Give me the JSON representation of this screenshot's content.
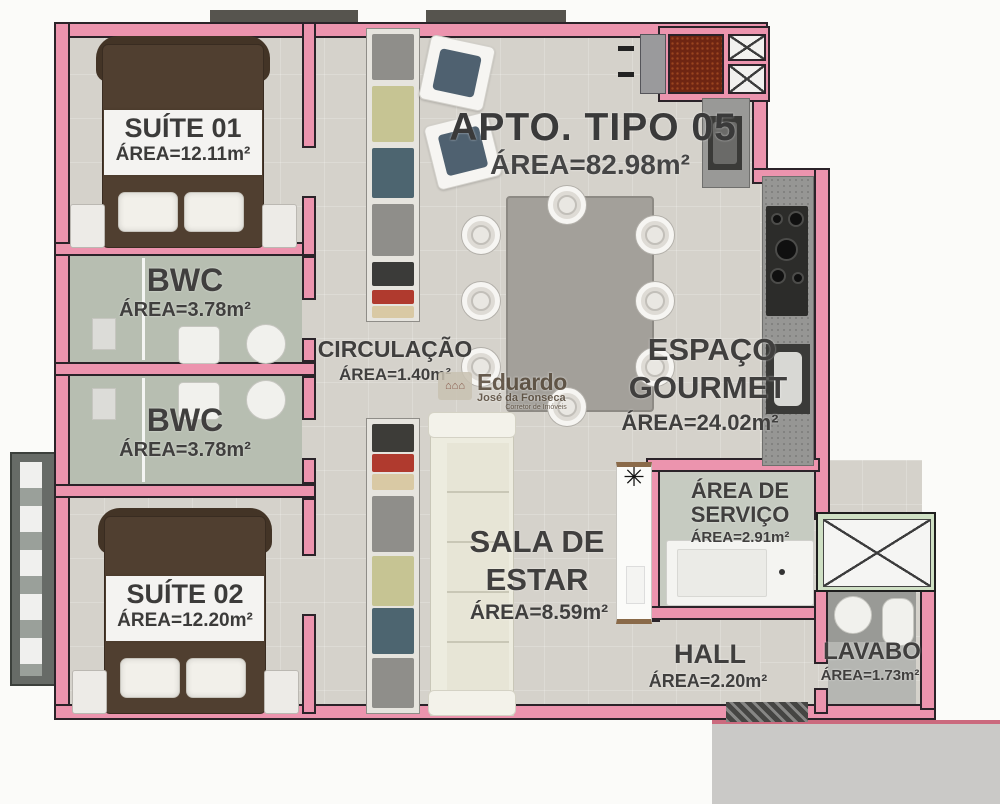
{
  "title": {
    "name": "APTO. TIPO 05",
    "area": "ÁREA=82.98m²"
  },
  "rooms": {
    "suite01": {
      "name": "SUÍTE 01",
      "area": "ÁREA=12.11m²"
    },
    "bwc1": {
      "name": "BWC",
      "area": "ÁREA=3.78m²"
    },
    "bwc2": {
      "name": "BWC",
      "area": "ÁREA=3.78m²"
    },
    "suite02": {
      "name": "SUÍTE 02",
      "area": "ÁREA=12.20m²"
    },
    "circulacao": {
      "name": "CIRCULAÇÃO",
      "area": "ÁREA=1.40m²"
    },
    "gourmet": {
      "line1": "ESPAÇO",
      "line2": "GOURMET",
      "area": "ÁREA=24.02m²"
    },
    "sala": {
      "line1": "SALA DE",
      "line2": "ESTAR",
      "area": "ÁREA=8.59m²"
    },
    "servico": {
      "line1": "ÁREA DE",
      "line2": "SERVIÇO",
      "area": "ÁREA=2.91m²"
    },
    "hall": {
      "name": "HALL",
      "area": "ÁREA=2.20m²"
    },
    "lavabo": {
      "name": "LAVABO",
      "area": "ÁREA=1.73m²"
    }
  },
  "watermark": {
    "name": "Eduardo",
    "subtitle": "José da Fonseca",
    "tagline": "Corretor de Imóveis"
  },
  "colors": {
    "wall_pink": "#ec94ae",
    "floor_gray": "#d5d2cb",
    "bwc_green": "#b7beb1",
    "bed_brown": "#503f30",
    "window_green": "#cfe0c4",
    "hatch_red": "#6e2512"
  }
}
